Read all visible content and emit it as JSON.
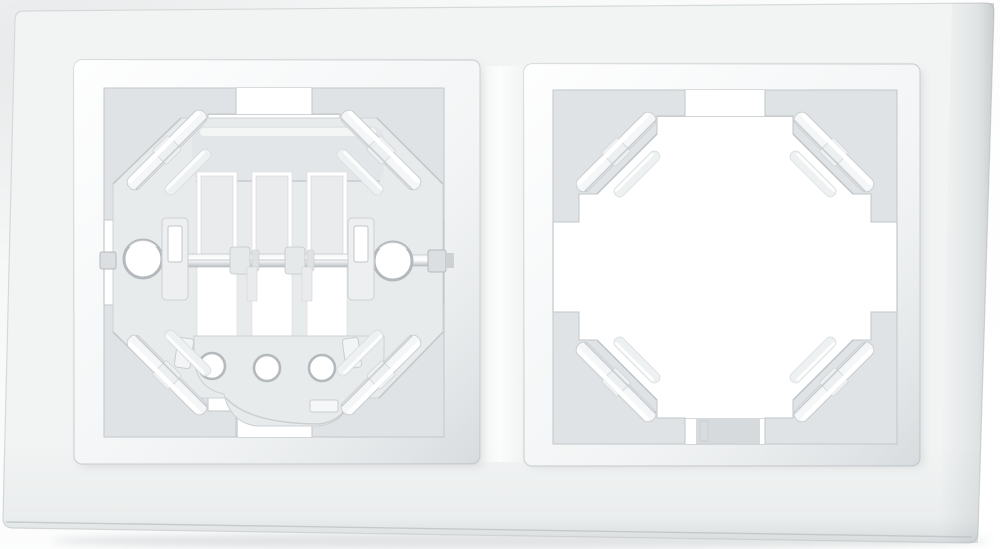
{
  "scene": {
    "type": "product-photo",
    "description": "White plastic double wall-plate frame (two-gang electrical frame) photographed on a white background. Left square aperture holds a socket mounting bracket: an octagonal support plate with three vertical slot windows, a horizontal metal axle with collars and end screw, two large round mounting holes, a lower plate with three small round holes and a rectangular notch. Right square aperture is empty, showing four diagonal corner fixing clips on grey gusset panels.",
    "background_color": "#fdfdfd",
    "parts": {
      "wall_plate": "outer white frame plate with rounded corners",
      "left_aperture": "aperture with mounting bracket installed",
      "right_aperture": "empty aperture with corner clips",
      "mounting_bracket": "octagonal support plate",
      "axle_rod": "horizontal metal rod with two collars and hex nut",
      "corner_clips": "eight diagonal spring clips, four per aperture",
      "large_holes": 2,
      "small_holes": 3,
      "slot_windows": 3
    },
    "colors": {
      "background": "#fdfdfd",
      "plate": "#f2f4f4",
      "plate_edge_dark": "#c2c6c9",
      "bevel": "#f4f6f7",
      "bevel_shadow": "#c9cdd1",
      "cavity": "#ffffff",
      "cavity_wall": "#cfd4d7",
      "rail_slot": "#c6cacd",
      "gusset": "#e0e3e5",
      "gusset_edge": "#c2c7ca",
      "clip": "#f4f6f7",
      "bracket": "#e8ebec",
      "hole_rim": "#b4b9bd",
      "slot_white": "#ffffff"
    }
  }
}
